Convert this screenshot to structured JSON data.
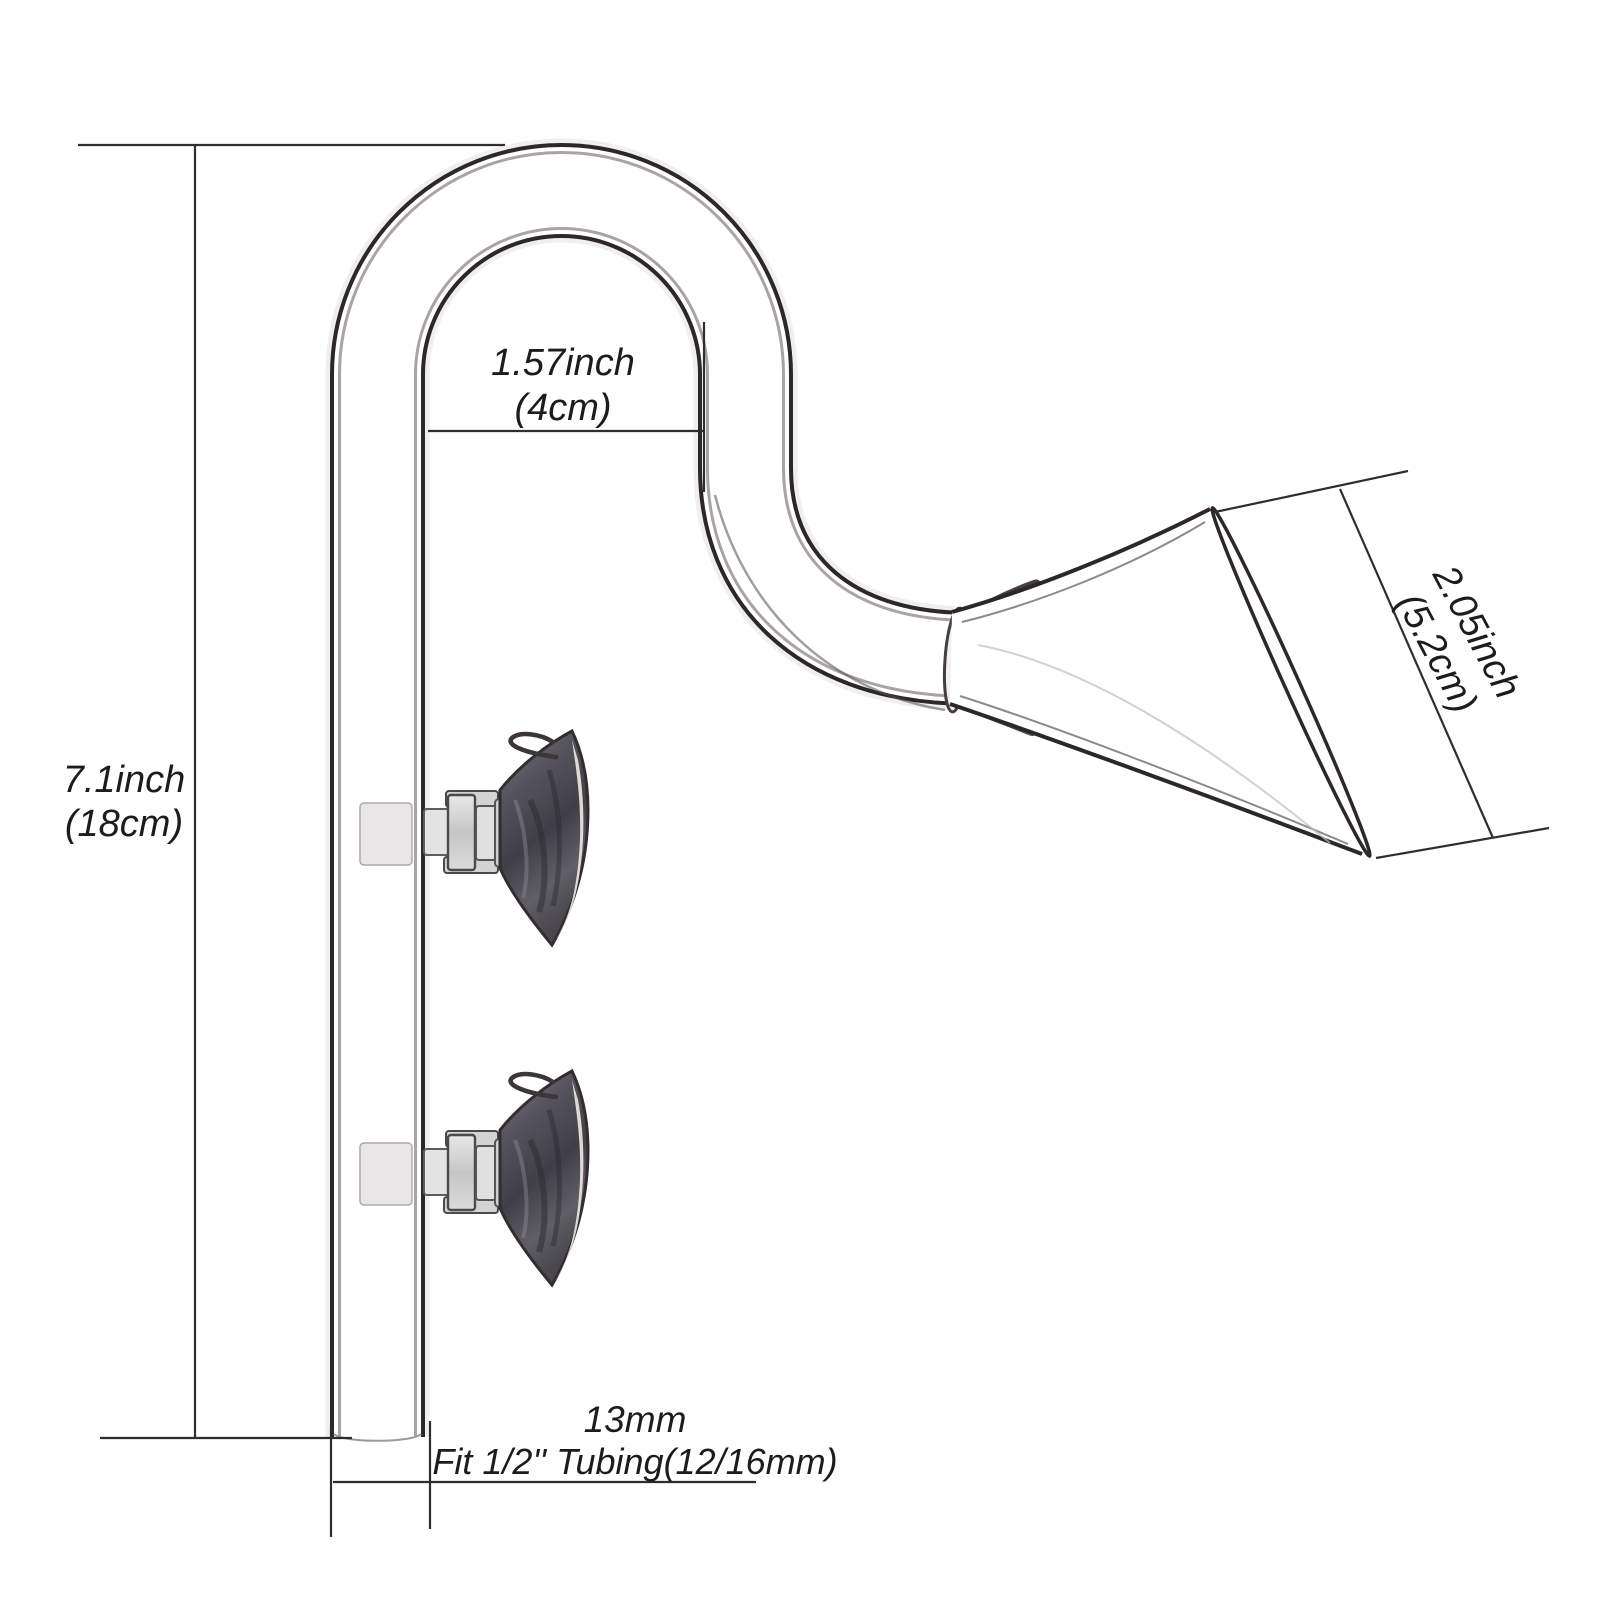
{
  "diagram": {
    "title": "glass lily pipe outflow dimension diagram",
    "background_color": "#ffffff",
    "dimension_line_color": "#2e2e2e",
    "glass_line_color": "#2d262a",
    "suction_cup_color": "#47454d",
    "labels": {
      "height": {
        "line1": "7.1inch",
        "line2": "(18cm)"
      },
      "hook_width": {
        "line1": "1.57inch",
        "line2": "(4cm)"
      },
      "outlet_mouth": {
        "line1": "2.05inch",
        "line2": "(5.2cm)"
      },
      "tube_outer_diameter": {
        "line1": "13mm"
      },
      "tubing_fit": {
        "line1": "Fit 1/2'' Tubing(12/16mm)"
      }
    }
  }
}
